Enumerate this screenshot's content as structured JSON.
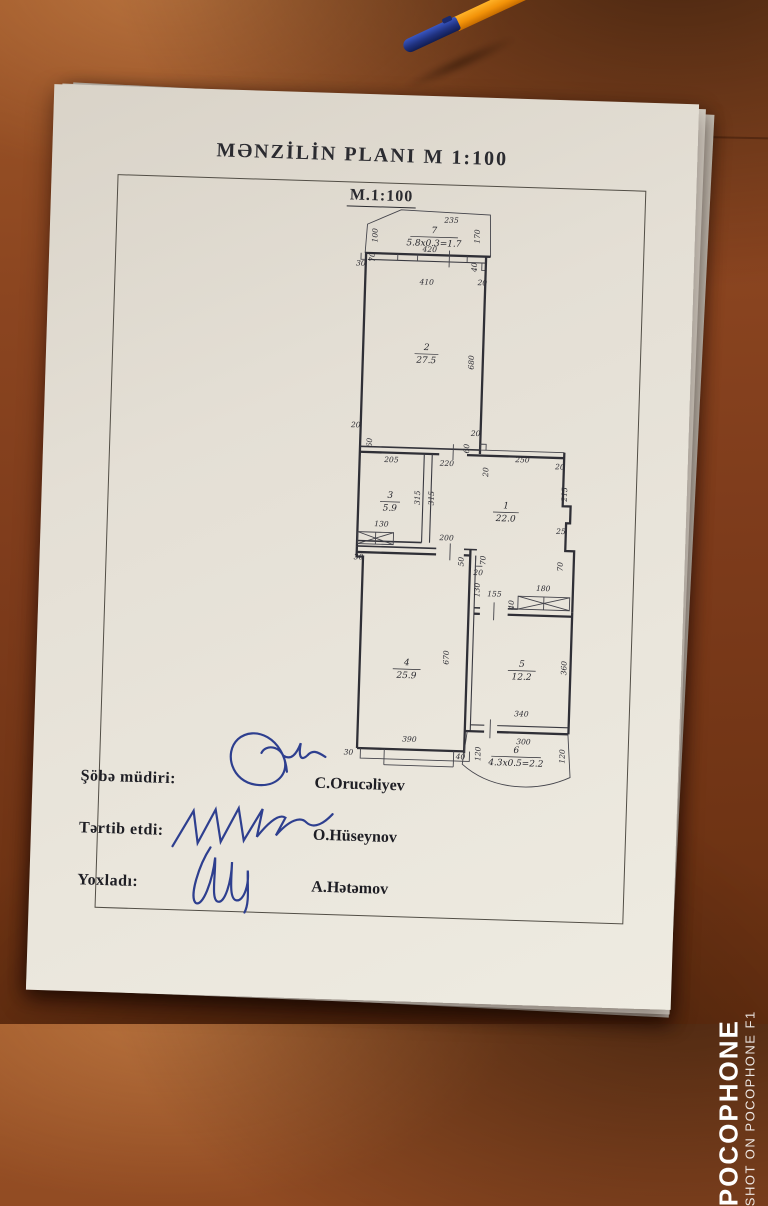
{
  "document": {
    "title": "MƏNZİLİN PLANI M 1:100",
    "scale_label": "M.1:100",
    "signature_rows": [
      {
        "role": "Şöbə müdiri:",
        "name": "C.Orucəliyev"
      },
      {
        "role": "Tərtib etdi:",
        "name": "O.Hüseynov"
      },
      {
        "role": "Yoxladı:",
        "name": "A.Hətəmov"
      }
    ]
  },
  "plan": {
    "rooms": [
      {
        "num": "1",
        "area": "22.0"
      },
      {
        "num": "2",
        "area": "27.5"
      },
      {
        "num": "3",
        "area": "5.9"
      },
      {
        "num": "4",
        "area": "25.9"
      },
      {
        "num": "5",
        "area": "12.2"
      },
      {
        "num": "6",
        "area": "4.3x0.5=2.2"
      },
      {
        "num": "7",
        "area": "5.8x0.3=1.7"
      }
    ],
    "dims": [
      "235",
      "420",
      "100",
      "170",
      "30",
      "70",
      "410",
      "40",
      "20",
      "680",
      "20",
      "60",
      "20",
      "60",
      "205",
      "220",
      "250",
      "20",
      "20",
      "315",
      "315",
      "130",
      "215",
      "25",
      "200",
      "30",
      "50",
      "70",
      "20",
      "130",
      "155",
      "40",
      "180",
      "70",
      "670",
      "390",
      "30",
      "40",
      "360",
      "340",
      "300",
      "120",
      "120"
    ]
  },
  "watermark": {
    "line1": "POCOPHONE",
    "line2": "SHOT ON POCOPHONE F1"
  },
  "colors": {
    "desk": "#8b4520",
    "paper": "#e6e1d7",
    "ink": "#35353a",
    "signature_ink": "#2e3f8f",
    "pen_body": "#f29a12",
    "pen_cap": "#1c3aa8",
    "watermark": "#ffffff"
  }
}
